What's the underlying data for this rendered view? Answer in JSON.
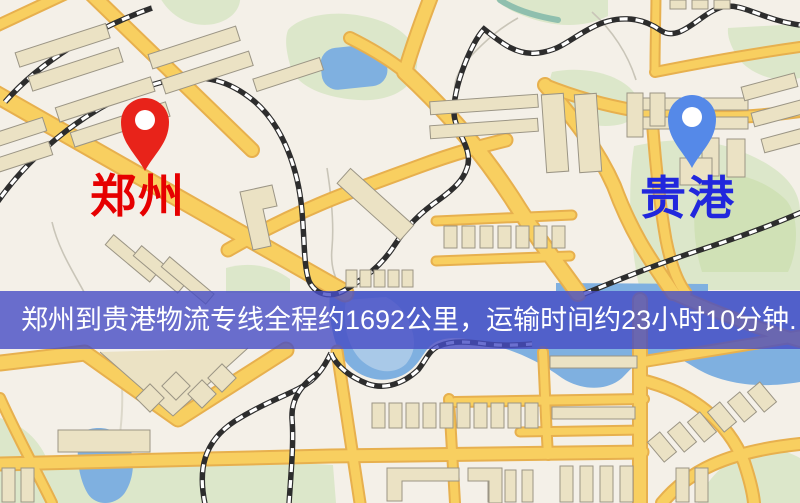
{
  "banner": {
    "text": "郑州到贵港物流专线全程约1692公里，运输时间约23小时10分钟.",
    "background_rgba": "rgba(70,76,196,0.8)",
    "text_color": "#ffffff"
  },
  "markers": {
    "origin": {
      "label": "郑州",
      "pin_color": "#e8231a",
      "label_color": "#e60000"
    },
    "destination": {
      "label": "贵港",
      "pin_color": "#5589e8",
      "label_color": "#2127dd"
    }
  },
  "route_info": {
    "origin_city": "郑州",
    "destination_city": "贵港",
    "distance_km": "1692",
    "duration": "23小时10分钟"
  },
  "map": {
    "colors": {
      "bg": "#f4f0e8",
      "green": "#dce7ca",
      "green_dark": "#d0e1b6",
      "water": "#7fb0e0",
      "water_light": "#a9c9e8",
      "road_fill": "#f8cf60",
      "road_casing": "#e7b04e",
      "building": "#ebe2c4",
      "building_stroke": "#9b9585",
      "railway": "#2d2d2d"
    }
  }
}
